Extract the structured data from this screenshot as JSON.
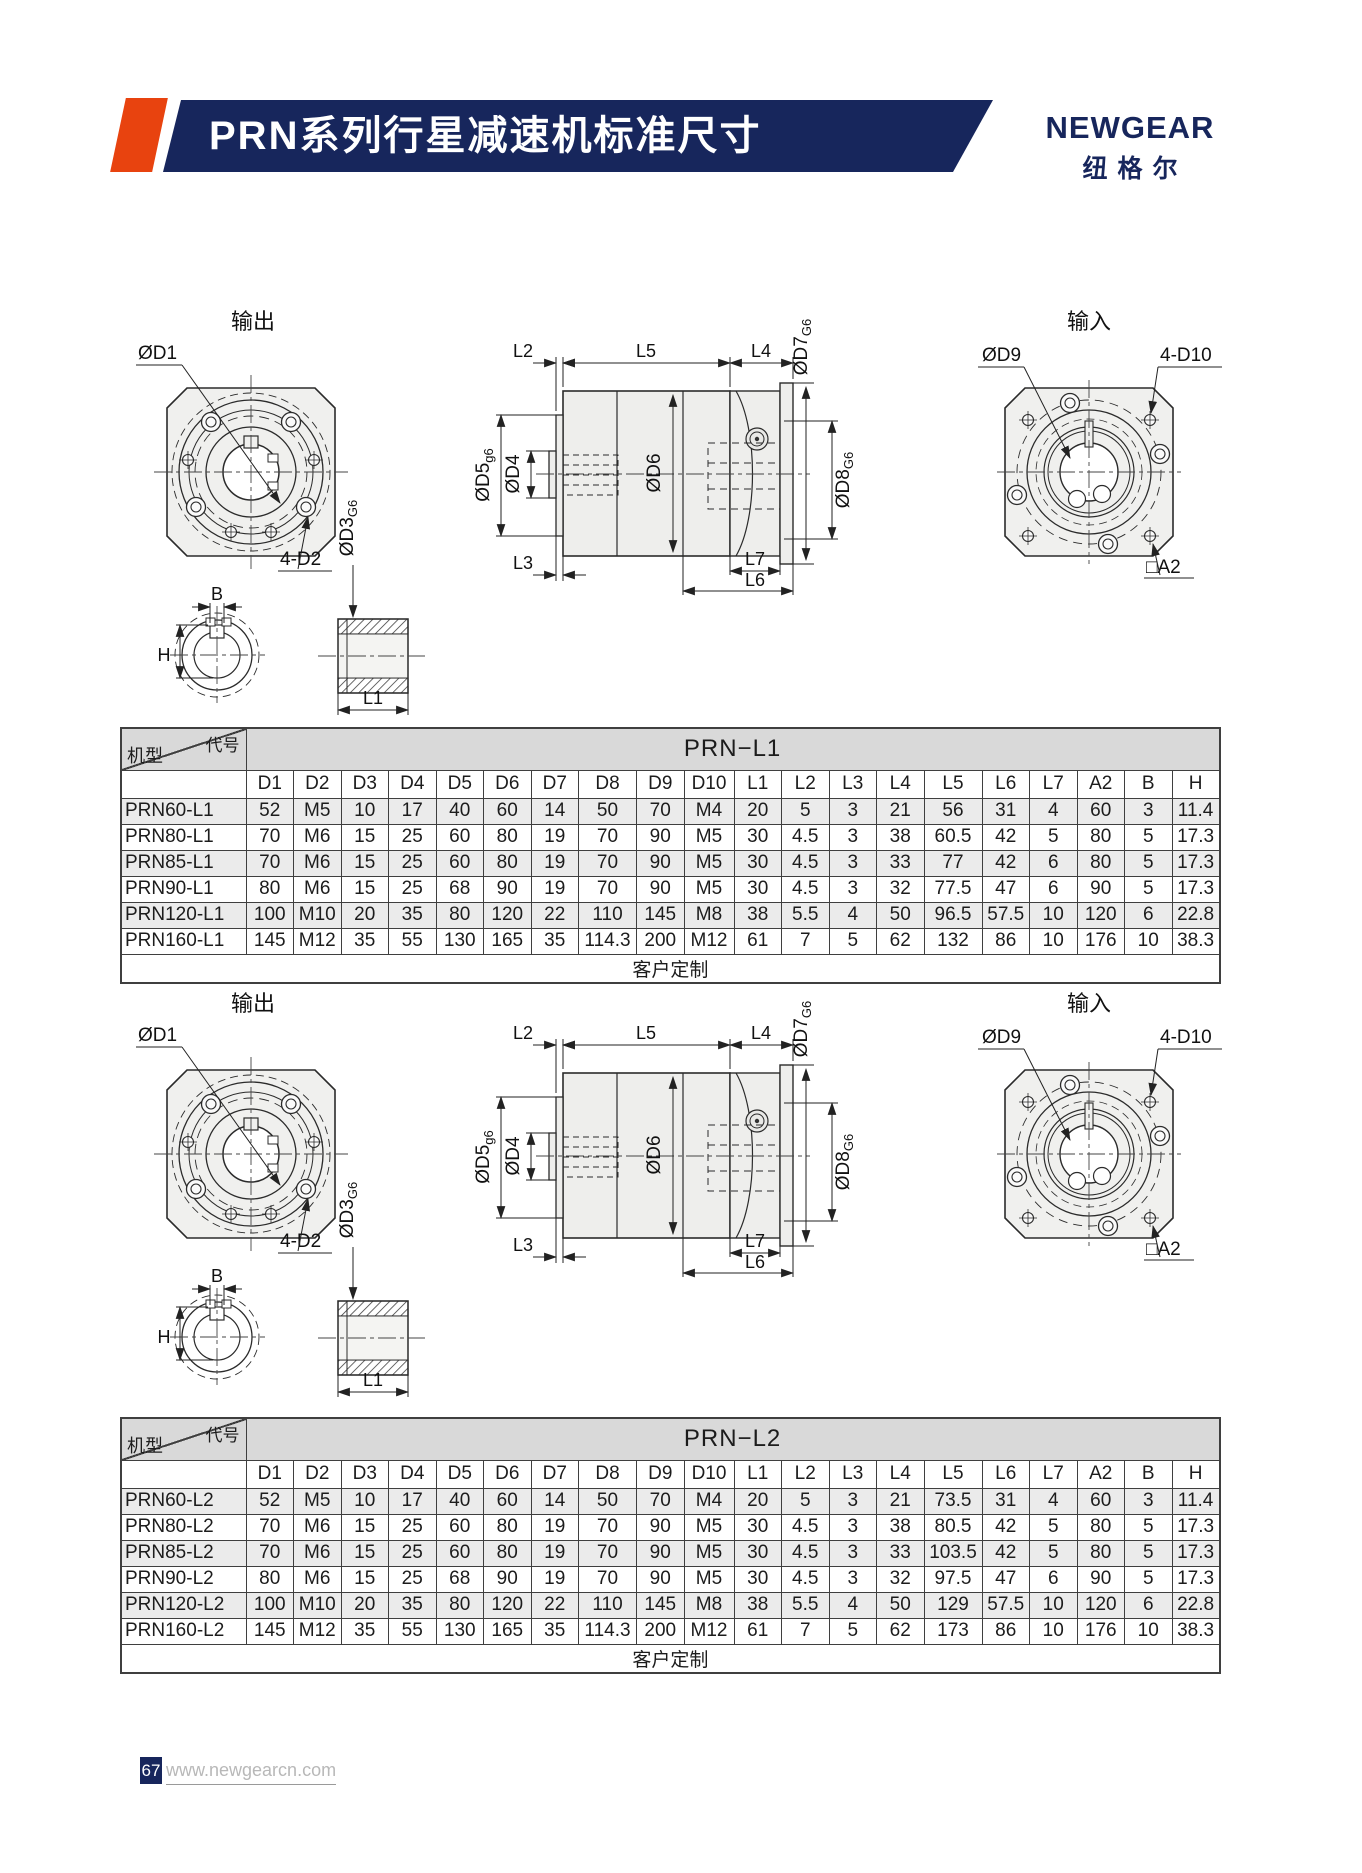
{
  "header": {
    "title": "PRN系列行星减速机标准尺寸",
    "brand": "NEWGEAR",
    "brand_cn": "纽格尔"
  },
  "colors": {
    "navy": "#17265c",
    "accent_red": "#e8430f",
    "table_band_gray": "#d9d9d9",
    "row_shade_gray": "#ebebeb",
    "drawing_fill": "#f0f0ee"
  },
  "drawings": {
    "output_title": "输出",
    "input_title": "输入",
    "labels": {
      "od1": "ØD1",
      "four_d2": "4-D2",
      "b": "B",
      "h": "H",
      "od3_base": "ØD3",
      "od3_sub": "G6",
      "l1": "L1",
      "l2": "L2",
      "l5": "L5",
      "l4": "L4",
      "od5_base": "ØD5",
      "od5_sub": "g6",
      "od4": "ØD4",
      "od6": "ØD6",
      "od7_base": "ØD7",
      "od7_sub": "G6",
      "od8_base": "ØD8",
      "od8_sub": "G6",
      "l3": "L3",
      "l7": "L7",
      "l6": "L6",
      "od9": "ØD9",
      "four_d10": "4-D10",
      "a2": "□A2"
    }
  },
  "tables": [
    {
      "title": "PRN−L1",
      "corner_top": "代号",
      "corner_bottom": "机型",
      "columns": [
        "D1",
        "D2",
        "D3",
        "D4",
        "D5",
        "D6",
        "D7",
        "D8",
        "D9",
        "D10",
        "L1",
        "L2",
        "L3",
        "L4",
        "L5",
        "L6",
        "L7",
        "A2",
        "B",
        "H"
      ],
      "rows": [
        {
          "model": "PRN60-L1",
          "values": [
            "52",
            "M5",
            "10",
            "17",
            "40",
            "60",
            "14",
            "50",
            "70",
            "M4",
            "20",
            "5",
            "3",
            "21",
            "56",
            "31",
            "4",
            "60",
            "3",
            "11.4"
          ]
        },
        {
          "model": "PRN80-L1",
          "values": [
            "70",
            "M6",
            "15",
            "25",
            "60",
            "80",
            "19",
            "70",
            "90",
            "M5",
            "30",
            "4.5",
            "3",
            "38",
            "60.5",
            "42",
            "5",
            "80",
            "5",
            "17.3"
          ]
        },
        {
          "model": "PRN85-L1",
          "values": [
            "70",
            "M6",
            "15",
            "25",
            "60",
            "80",
            "19",
            "70",
            "90",
            "M5",
            "30",
            "4.5",
            "3",
            "33",
            "77",
            "42",
            "6",
            "80",
            "5",
            "17.3"
          ]
        },
        {
          "model": "PRN90-L1",
          "values": [
            "80",
            "M6",
            "15",
            "25",
            "68",
            "90",
            "19",
            "70",
            "90",
            "M5",
            "30",
            "4.5",
            "3",
            "32",
            "77.5",
            "47",
            "6",
            "90",
            "5",
            "17.3"
          ]
        },
        {
          "model": "PRN120-L1",
          "values": [
            "100",
            "M10",
            "20",
            "35",
            "80",
            "120",
            "22",
            "110",
            "145",
            "M8",
            "38",
            "5.5",
            "4",
            "50",
            "96.5",
            "57.5",
            "10",
            "120",
            "6",
            "22.8"
          ]
        },
        {
          "model": "PRN160-L1",
          "values": [
            "145",
            "M12",
            "35",
            "55",
            "130",
            "165",
            "35",
            "114.3",
            "200",
            "M12",
            "61",
            "7",
            "5",
            "62",
            "132",
            "86",
            "10",
            "176",
            "10",
            "38.3"
          ]
        }
      ],
      "footer": "客户定制"
    },
    {
      "title": "PRN−L2",
      "corner_top": "代号",
      "corner_bottom": "机型",
      "columns": [
        "D1",
        "D2",
        "D3",
        "D4",
        "D5",
        "D6",
        "D7",
        "D8",
        "D9",
        "D10",
        "L1",
        "L2",
        "L3",
        "L4",
        "L5",
        "L6",
        "L7",
        "A2",
        "B",
        "H"
      ],
      "rows": [
        {
          "model": "PRN60-L2",
          "values": [
            "52",
            "M5",
            "10",
            "17",
            "40",
            "60",
            "14",
            "50",
            "70",
            "M4",
            "20",
            "5",
            "3",
            "21",
            "73.5",
            "31",
            "4",
            "60",
            "3",
            "11.4"
          ]
        },
        {
          "model": "PRN80-L2",
          "values": [
            "70",
            "M6",
            "15",
            "25",
            "60",
            "80",
            "19",
            "70",
            "90",
            "M5",
            "30",
            "4.5",
            "3",
            "38",
            "80.5",
            "42",
            "5",
            "80",
            "5",
            "17.3"
          ]
        },
        {
          "model": "PRN85-L2",
          "values": [
            "70",
            "M6",
            "15",
            "25",
            "60",
            "80",
            "19",
            "70",
            "90",
            "M5",
            "30",
            "4.5",
            "3",
            "33",
            "103.5",
            "42",
            "5",
            "80",
            "5",
            "17.3"
          ]
        },
        {
          "model": "PRN90-L2",
          "values": [
            "80",
            "M6",
            "15",
            "25",
            "68",
            "90",
            "19",
            "70",
            "90",
            "M5",
            "30",
            "4.5",
            "3",
            "32",
            "97.5",
            "47",
            "6",
            "90",
            "5",
            "17.3"
          ]
        },
        {
          "model": "PRN120-L2",
          "values": [
            "100",
            "M10",
            "20",
            "35",
            "80",
            "120",
            "22",
            "110",
            "145",
            "M8",
            "38",
            "5.5",
            "4",
            "50",
            "129",
            "57.5",
            "10",
            "120",
            "6",
            "22.8"
          ]
        },
        {
          "model": "PRN160-L2",
          "values": [
            "145",
            "M12",
            "35",
            "55",
            "130",
            "165",
            "35",
            "114.3",
            "200",
            "M12",
            "61",
            "7",
            "5",
            "62",
            "173",
            "86",
            "10",
            "176",
            "10",
            "38.3"
          ]
        }
      ],
      "footer": "客户定制"
    }
  ],
  "footer": {
    "page": "67",
    "url": "www.newgearcn.com"
  }
}
